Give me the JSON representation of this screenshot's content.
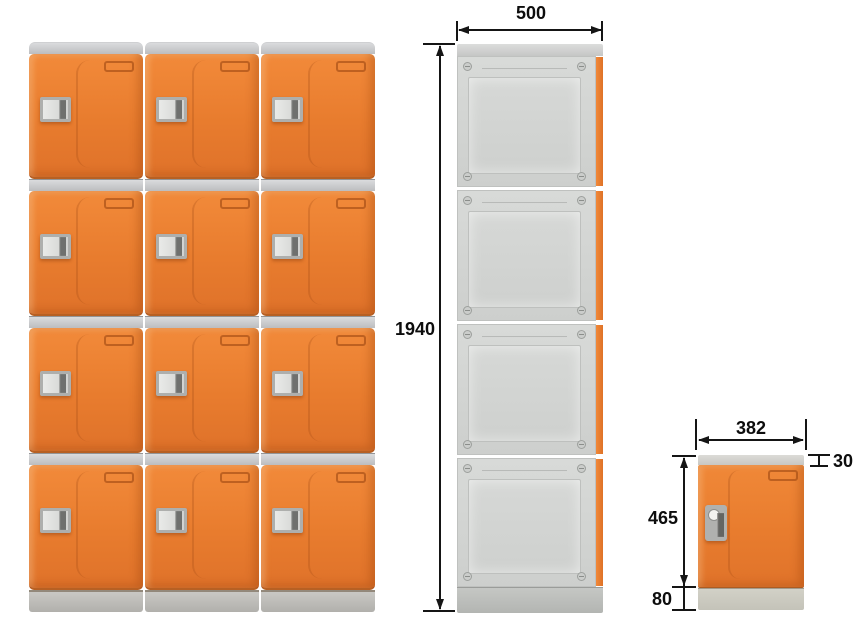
{
  "diagram": {
    "kind": "locker-dimension-drawing",
    "views": {
      "front": {
        "name": "front view",
        "columns": 3,
        "rows": 4
      },
      "side": {
        "name": "side view",
        "sections": 4
      },
      "single": {
        "name": "single unit view"
      }
    },
    "dimensions": {
      "side_width": {
        "value": "500"
      },
      "total_height": {
        "value": "1940"
      },
      "unit_width": {
        "value": "382"
      },
      "top_height": {
        "value": "30"
      },
      "door_height": {
        "value": "465"
      },
      "base_height": {
        "value": "80"
      }
    },
    "colors": {
      "door_orange": "#E87C2E",
      "panel_gray": "#D4D6D4",
      "strip_gray": "#C5C6C8",
      "base_gray": "#B9B8B4",
      "dimension_line": "#151515",
      "background": "#FFFFFF"
    }
  }
}
